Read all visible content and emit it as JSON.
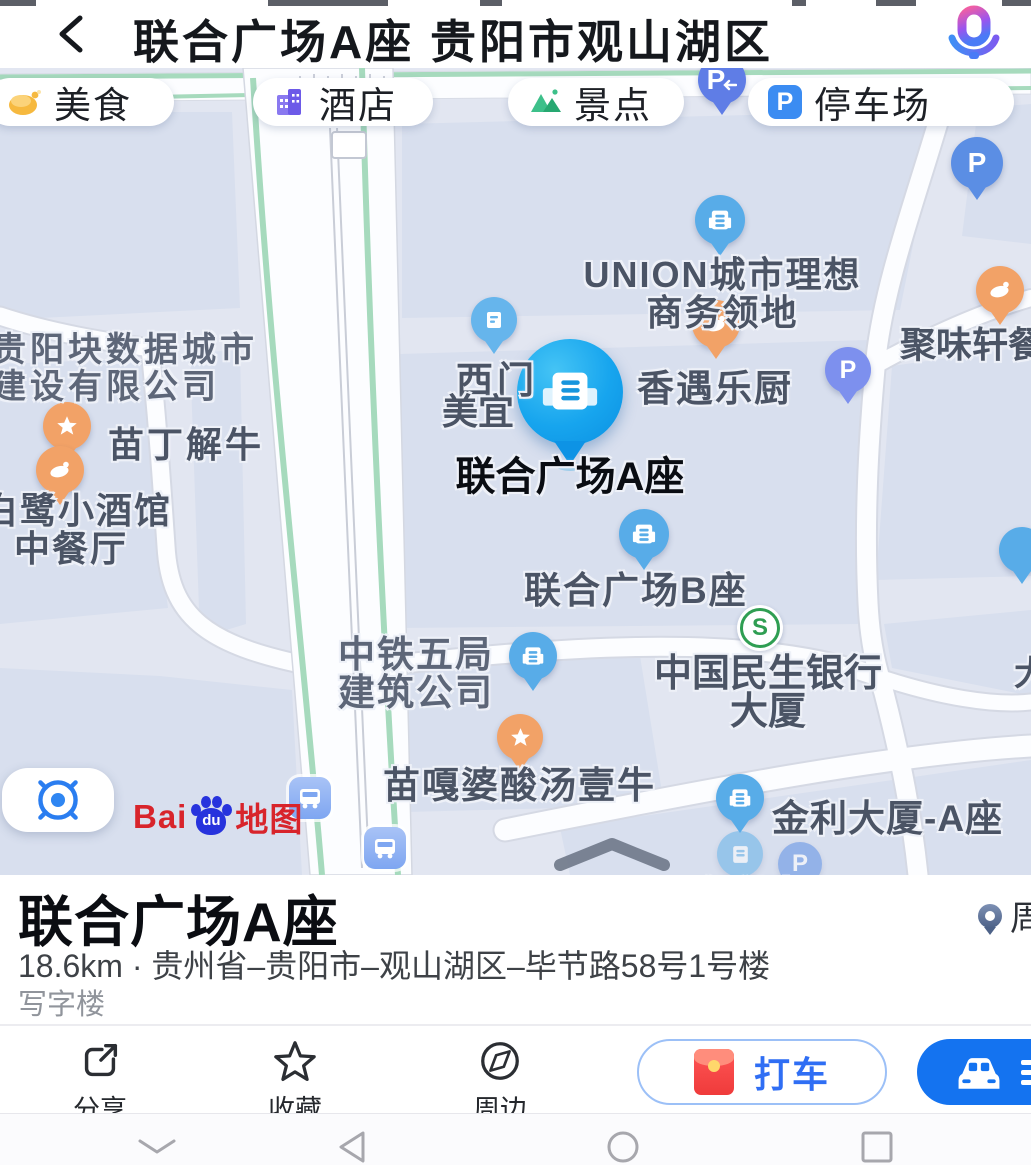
{
  "header": {
    "title": "联合广场A座 贵阳市观山湖区"
  },
  "chips": {
    "food": "美食",
    "hotel": "酒店",
    "scenic": "景点",
    "parking": "停车场"
  },
  "icons": {
    "p_letter": "P",
    "bank_letter": "S"
  },
  "map": {
    "labels": {
      "union_line1": "UNION城市理想",
      "union_line2": "商务领地",
      "juweixuan": "聚味轩餐",
      "guiyang_line1": "贵阳块数据城市",
      "guiyang_line2": "建设有限公司",
      "ximen": "西门",
      "xiangyu": "香遇乐厨",
      "meiyi": "美宜",
      "main_poi": "联合广场A座",
      "miaoding": "苗丁解牛",
      "egret_line1": "白鹭小酒馆",
      "egret_line2": "中餐厅",
      "union_b": "联合广场B座",
      "zhongtie_line1": "中铁五局",
      "zhongtie_line2": "建筑公司",
      "minsheng_line1": "中国民生银行",
      "minsheng_line2": "大厦",
      "miaogapo": "苗嘎婆酸汤壹牛",
      "jinli_a": "金利大厦-A座",
      "jinli_faded": "金利大厦",
      "edge_partial": "大"
    },
    "logo": {
      "bai": "Bai",
      "du": "du",
      "map_word": "地图"
    }
  },
  "sheet": {
    "title": "联合广场A座",
    "meta": "18.6km · 贵州省–贵阳市–观山湖区–毕节路58号1号楼",
    "category": "写字楼",
    "nearby_partial": "周"
  },
  "actions": {
    "share": "分享",
    "favorite": "收藏",
    "nearby": "周边",
    "taxi": "打车"
  }
}
